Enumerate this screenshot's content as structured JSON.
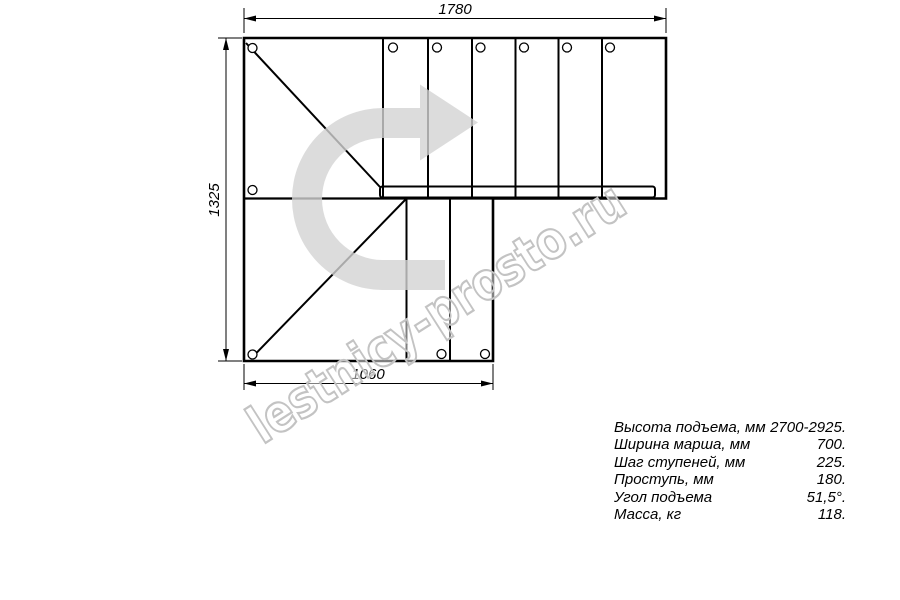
{
  "drawing": {
    "title": "staircase-plan-top-view",
    "dimension_labels": {
      "top": "1780",
      "left": "1325",
      "bottom": "1060"
    },
    "watermark": "lestnicy-prosto.ru",
    "colors": {
      "line": "#000000",
      "dimension": "#000000",
      "arrow_fill": "#d3d3d3",
      "watermark_stroke": "#c3c3c3"
    }
  },
  "specs": {
    "rows": [
      {
        "label": "Высота подъема, мм",
        "value": "2700-2925."
      },
      {
        "label": "Ширина марша, мм",
        "value": "700."
      },
      {
        "label": "Шаг ступеней, мм",
        "value": "225."
      },
      {
        "label": "Проступь, мм",
        "value": "180."
      },
      {
        "label": "Угол подъема",
        "value": "51,5°."
      },
      {
        "label": "Масса, кг",
        "value": "118."
      }
    ]
  }
}
